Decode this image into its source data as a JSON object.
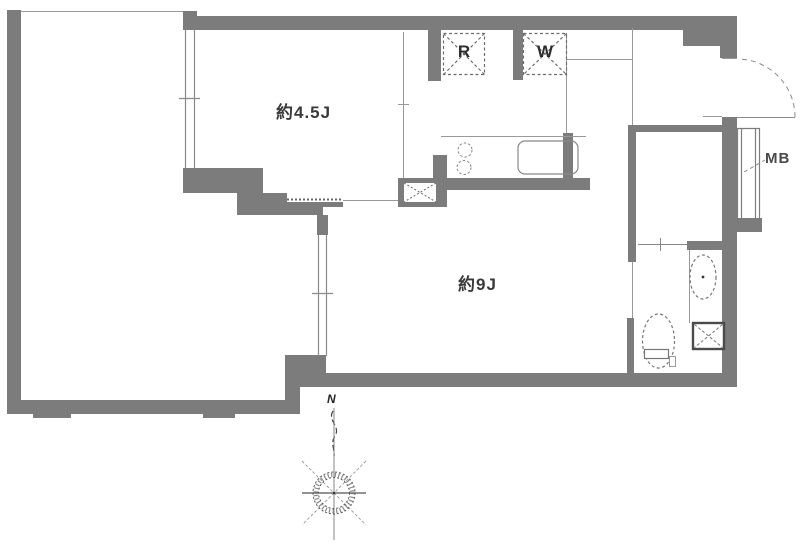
{
  "labels": {
    "room_sub": "約4.5J",
    "room_main": "約9J",
    "refrigerator": "R",
    "washer": "W",
    "meter_box": "MB",
    "compass_north": "N"
  },
  "colors": {
    "wall": "#7c7c7c",
    "thin_line": "#999999",
    "fixture_line": "#777777",
    "text": "#3a3a3a",
    "background": "#ffffff"
  }
}
